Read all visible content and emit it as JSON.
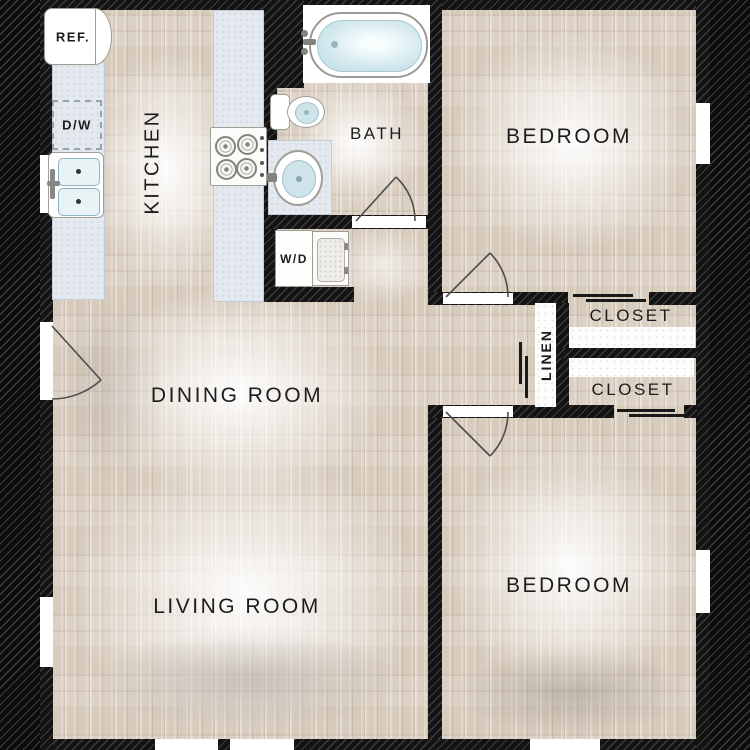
{
  "rooms": {
    "kitchen": "KITCHEN",
    "bath": "BATH",
    "bedroom_top": "BEDROOM",
    "dining_room": "DINING ROOM",
    "living_room": "LIVING ROOM",
    "bedroom_bottom": "BEDROOM",
    "closet_top": "CLOSET",
    "closet_bottom": "CLOSET",
    "linen": "LINEN"
  },
  "appliances": {
    "refrigerator": "REF.",
    "dishwasher": "D/W",
    "washer_dryer": "W/D"
  },
  "colors": {
    "background_hatch": "#0c0c0c",
    "wall": "#131313",
    "floor": "#d7cbbc",
    "counter": "#e3e9ef",
    "fixture_white": "#ffffff",
    "water_blue": "#c4e0e6",
    "label_text": "#1c1c1c"
  }
}
